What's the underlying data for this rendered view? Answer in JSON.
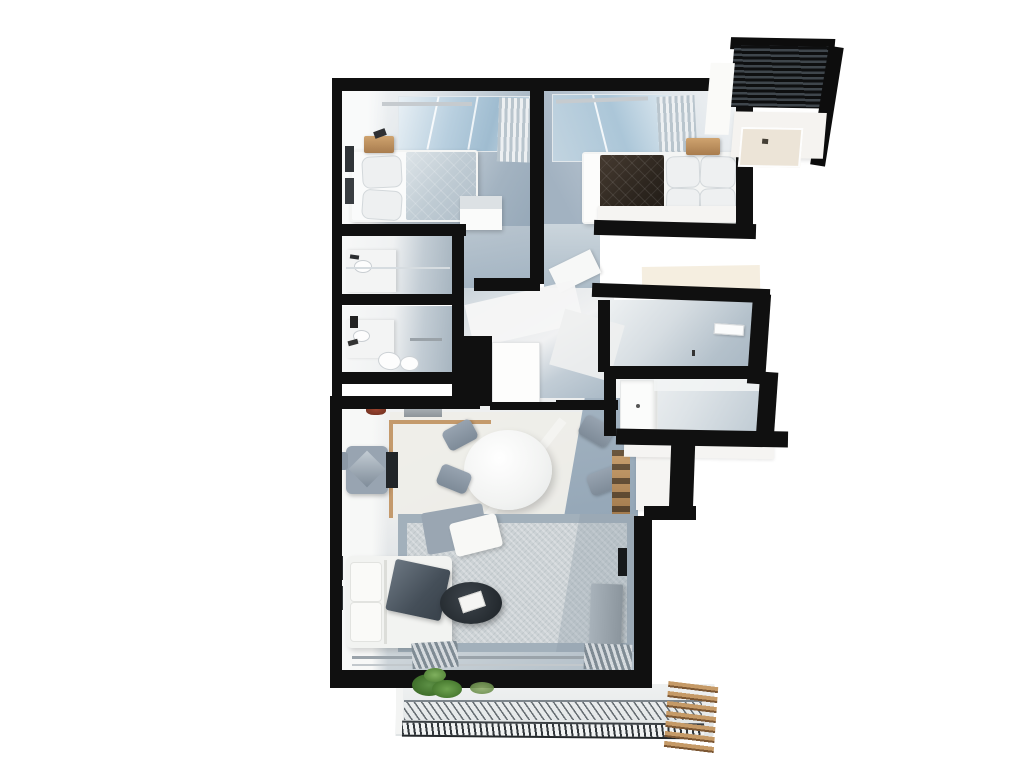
{
  "scene": {
    "kind": "3d-floor-plan-render",
    "view": "top-down",
    "background": "#ffffff",
    "plan_bounds": {
      "x": 330,
      "y": 26,
      "width": 470,
      "height": 724
    }
  },
  "palette": {
    "wall": "#101010",
    "floor_cool": "#a3b3c1",
    "floor_cool_light": "#dfe5ea",
    "floor_concrete": "#eceeef",
    "floor_warm": "#eeede7",
    "glass": "#abc6d8",
    "wood": "#c49a6c",
    "rug_border": "#a2b0bb",
    "rug_field": "#ccd2d5",
    "sofa_white": "#f2f3f1",
    "cushion_gray": "#9aa6b2",
    "throw_dark": "#454f59",
    "bed_dark_quilt": "#2c251e",
    "table_white": "#fbfbfa",
    "chair_gray": "#8d99a6",
    "coffee_table": "#262c31",
    "plant_green": "#4a7a30",
    "deck_slat_dark": "#0e0f10",
    "deck_slat_light": "#3f464c",
    "louver_wood": "#c59a67"
  },
  "rooms": [
    {
      "name": "bedroom-left",
      "furniture": [
        "double-bed",
        "duvet",
        "blanket",
        "pillows",
        "nightstand",
        "decor-object",
        "wall-frames",
        "glass-partition",
        "curtain",
        "bench"
      ]
    },
    {
      "name": "bedroom-right",
      "furniture": [
        "double-bed",
        "dark-quilt",
        "pillows",
        "white-sheet",
        "nightstand",
        "glass-partition",
        "curtain",
        "open-door-panel"
      ]
    },
    {
      "name": "bathroom-upper",
      "furniture": [
        "vanity",
        "sink",
        "glass-screen",
        "fixture"
      ]
    },
    {
      "name": "bathroom-lower",
      "furniture": [
        "vanity",
        "sink",
        "toilet",
        "bidet",
        "towel-rail",
        "black-taps"
      ]
    },
    {
      "name": "hallway",
      "furniture": [
        "door-panel",
        "wall-wedges"
      ]
    },
    {
      "name": "utility-room",
      "furniture": [
        "ac-unit"
      ]
    },
    {
      "name": "kitchen-nook",
      "furniture": [
        "tall-cabinet",
        "counter"
      ]
    },
    {
      "name": "living-room",
      "chair_count": 4,
      "furniture": [
        "round-dining-table",
        "dining-chairs",
        "armchair",
        "desk",
        "side-stool",
        "wall-shelf",
        "red-plant",
        "wood-floor-trim",
        "rug",
        "chaise-cushion",
        "white-pillow",
        "sofa",
        "throw-blanket",
        "coffee-table",
        "book-tray",
        "media-console",
        "tv",
        "built-in-shelf",
        "sliding-glass-door",
        "folded-curtains",
        "wall-frames"
      ]
    },
    {
      "name": "balcony-bottom",
      "furniture": [
        "terrace-floor",
        "potted-plants",
        "hatched-railing",
        "wood-louvers"
      ]
    },
    {
      "name": "balcony-top-right",
      "furniture": [
        "slatted-deck",
        "black-parapet",
        "white-parapet",
        "inner-window"
      ]
    }
  ]
}
